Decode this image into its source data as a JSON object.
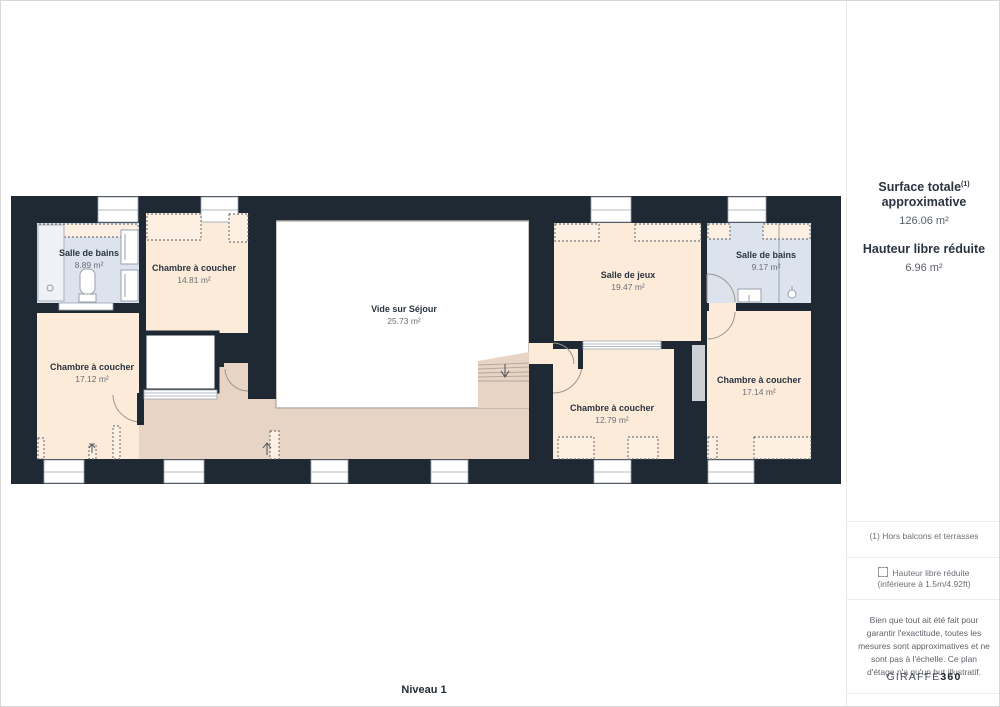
{
  "plan": {
    "floor_label": "Niveau 1",
    "colors": {
      "wall": "#1e2934",
      "room_peach": "#fcebd9",
      "room_blue": "#dde3ed",
      "corridor_tan": "#e8d4c4",
      "void_white": "#ffffff"
    },
    "rooms": [
      {
        "id": "salle-de-bains-ouest",
        "name": "Salle de bains",
        "area": "8.89 m²"
      },
      {
        "id": "chambre-nord-ouest",
        "name": "Chambre à coucher",
        "area": "14.81 m²"
      },
      {
        "id": "chambre-sud-ouest",
        "name": "Chambre à coucher",
        "area": "17.12 m²"
      },
      {
        "id": "vide-sur-sejour",
        "name": "Vide sur Séjour",
        "area": "25.73 m²"
      },
      {
        "id": "salle-de-jeux",
        "name": "Salle de jeux",
        "area": "19.47 m²"
      },
      {
        "id": "salle-de-bains-est",
        "name": "Salle de bains",
        "area": "9.17 m²"
      },
      {
        "id": "chambre-sud",
        "name": "Chambre à coucher",
        "area": "12.79 m²"
      },
      {
        "id": "chambre-sud-est",
        "name": "Chambre à coucher",
        "area": "17.14 m²"
      }
    ]
  },
  "sidebar": {
    "surface_title_line1": "Surface totale",
    "surface_title_sup": "(1)",
    "surface_title_line2": "approximative",
    "surface_value": "126.06 m²",
    "height_title": "Hauteur libre réduite",
    "height_value": "6.96 m²",
    "note_balconies": "(1) Hors balcons et terrasses",
    "legend_reduced_line1": "Hauteur libre réduite",
    "legend_reduced_line2": "(inférieure à 1.5m/4.92ft)",
    "disclaimer": "Bien que tout ait été fait pour garantir l'exactitude, toutes les mesures sont approximatives et ne sont pas à l'échelle. Ce plan d'étage n'a qu'un but illustratif.",
    "brand_name": "GIRAFFE",
    "brand_suffix": "360"
  }
}
